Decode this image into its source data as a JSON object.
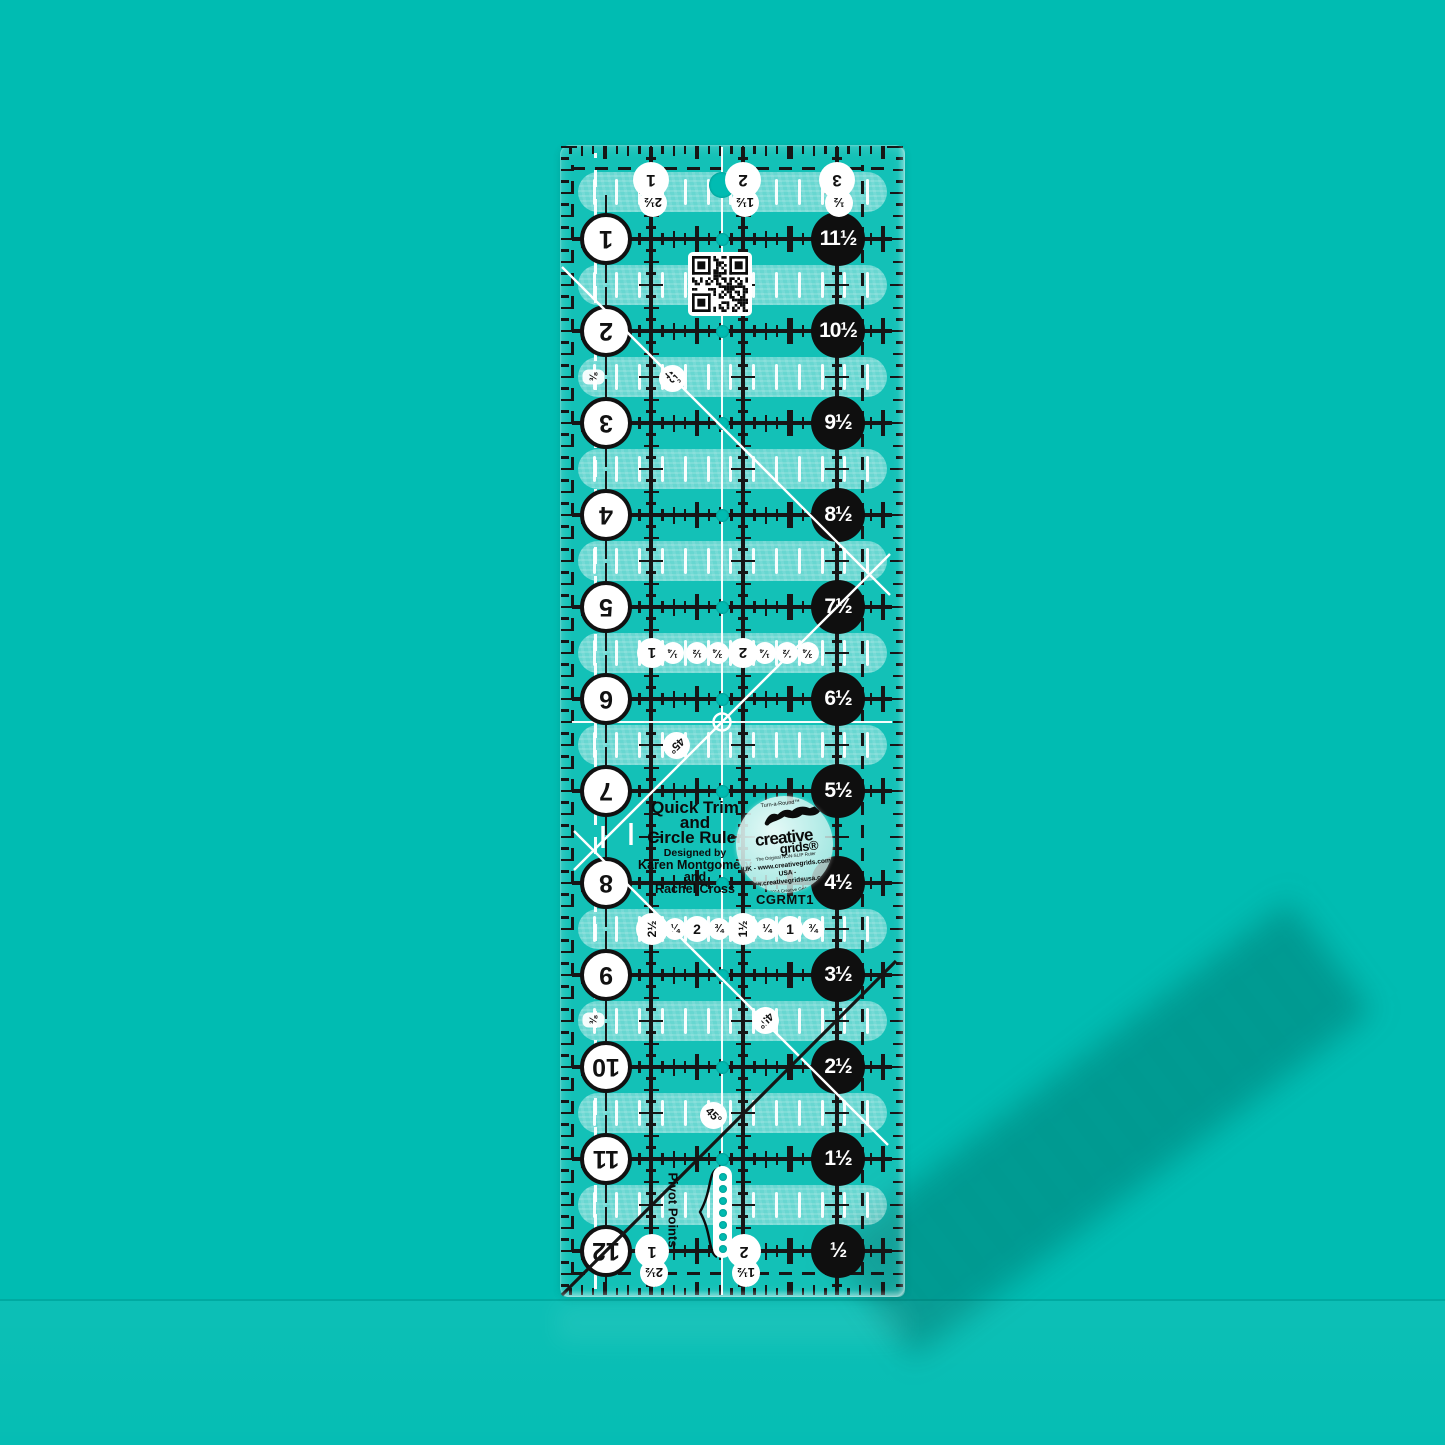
{
  "product": {
    "title_line1": "Quick Trim",
    "title_line2": "and",
    "title_line3": "Circle Ruler",
    "designed_by": "Designed by",
    "designer_line1": "Karen Montgomery",
    "designer_line2": "and",
    "designer_line3": "Rachel Cross",
    "sku": "CGRMT1",
    "pivot_label": "Pivot Points"
  },
  "logo": {
    "turn_a_round": "Turn-a-Round™",
    "brand_word1": "creative",
    "brand_word2": "grids®",
    "tagline": "The Original NON-SLIP Ruler",
    "uk_line": "UK - www.creativegrids.com",
    "usa_line": "USA - www.creativegridsusa.com",
    "copyright_line": "© 2014 Creative Grids ®",
    "patent_line1": "Eur. Pat. # 1522948",
    "patent_line2": "U.S. Pat # 6,925,724",
    "made_in": "MADE IN USA"
  },
  "scales": {
    "left_numbers": [
      "1",
      "2",
      "3",
      "4",
      "5",
      "6",
      "7",
      "8",
      "9",
      "10",
      "11",
      "12"
    ],
    "right_numbers": [
      "11½",
      "10½",
      "9½",
      "8½",
      "7½",
      "6½",
      "5½",
      "4½",
      "3½",
      "2½",
      "1½",
      "½"
    ],
    "top_numbers": [
      "1",
      "2",
      "3"
    ],
    "top_half_numbers": [
      "2½",
      "1½",
      "½"
    ],
    "bottom_numbers": [
      "1",
      "2"
    ],
    "bottom_half_numbers": [
      "2½",
      "1½"
    ],
    "mid_fraction_row": [
      "1",
      "¼",
      "½",
      "¾",
      "2",
      "¼",
      "½",
      "¾"
    ],
    "lower_fraction_row": [
      "2½",
      "¼",
      "2",
      "¾",
      "1½",
      "¼",
      "1",
      "¾"
    ],
    "angle_label": "45°",
    "eighth_label": "⅜"
  },
  "colors": {
    "background": "#00bcb2",
    "mark_black": "#161616",
    "mark_white": "#ffffff",
    "shadow": "#004d48"
  }
}
